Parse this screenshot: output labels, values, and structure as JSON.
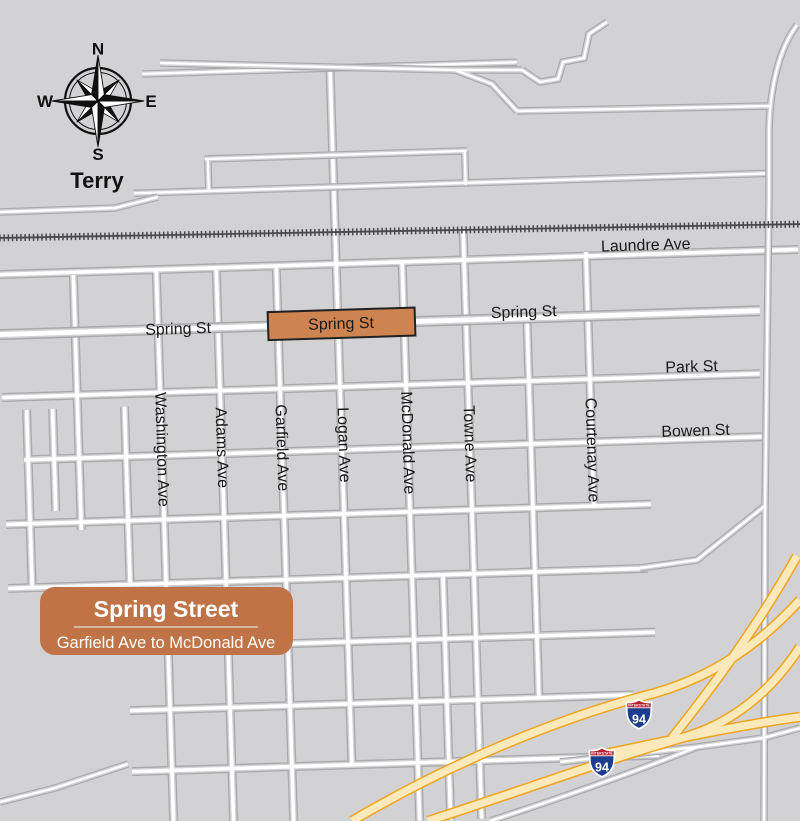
{
  "map": {
    "place_label": "Terry",
    "compass": {
      "north": "N",
      "east": "E",
      "south": "S",
      "west": "W"
    },
    "street_labels": {
      "laundre": "Laundre Ave",
      "spring_left": "Spring St",
      "spring_box": "Spring St",
      "spring_right": "Spring St",
      "park": "Park St",
      "bowen": "Bowen St",
      "washington": "Washington Ave",
      "adams": "Adams Ave",
      "garfield": "Garfield Ave",
      "logan": "Logan Ave",
      "mcdonald": "McDonald Ave",
      "towne": "Towne Ave",
      "courtenay": "Courtenay Ave"
    },
    "highway_shields": [
      {
        "system": "INTERSTATE",
        "route": "94"
      },
      {
        "system": "INTERSTATE",
        "route": "94"
      }
    ],
    "legend": {
      "title": "Spring Street",
      "subtitle": "Garfield Ave to McDonald Ave"
    },
    "colors": {
      "background": "#d2d2d4",
      "road_casing": "#a9a9ac",
      "railroad": "#4a4a4c",
      "highlight_fill": "#ce8450",
      "highlight_border": "#222222",
      "legend_bg": "#bf7347",
      "highway_fill": "#fbe9bb",
      "highway_casing": "#f2a41d",
      "shield_blue": "#1d3e8e",
      "shield_red": "#b3202f",
      "label_text": "#1a1a1a"
    }
  }
}
